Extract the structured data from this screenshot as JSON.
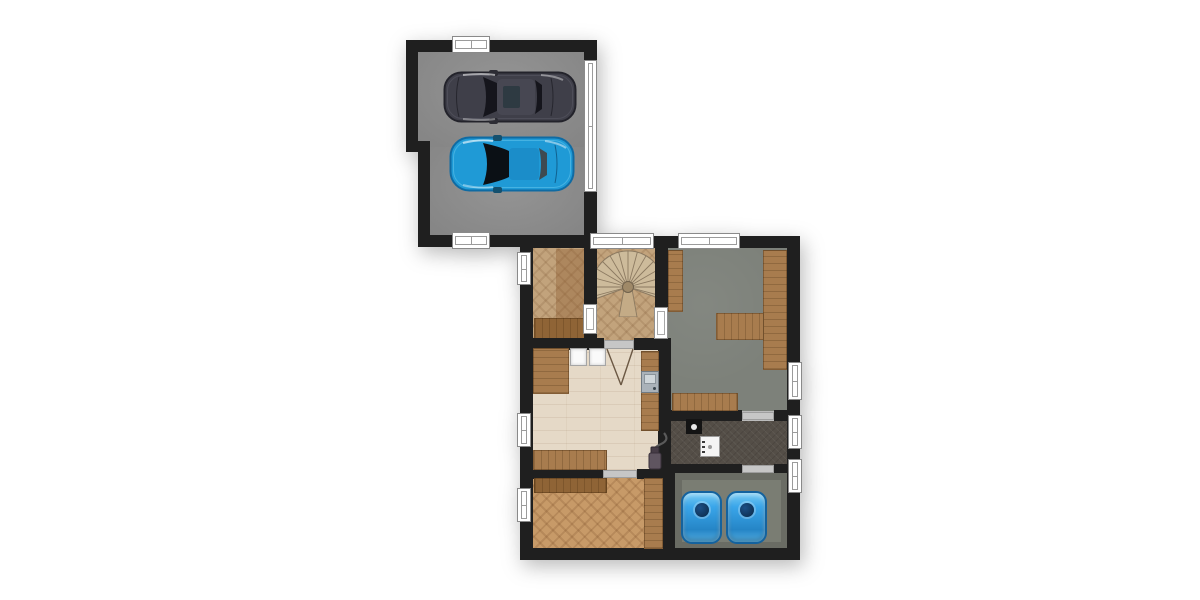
{
  "meta": {
    "description": "Top-down architectural floor plan: two-car garage attached to a lower level with stair hall, workshop, utility rooms and tank room",
    "visible_text": "none"
  },
  "colors": {
    "wall": "#1f1f1f",
    "garage_floor": "#8e8e8e",
    "workshop_floor": "#7d817a",
    "boiler_floor": "#544e47",
    "tank_floor": "#7a7d73",
    "kitchen_floor": "#e5d9c7",
    "parquet": "#c2a37c",
    "parquet_warm": "#c79a68",
    "wood": "#a87c4e",
    "wood_dark": "#8f6436",
    "window_frame": "#8a8a8a",
    "door_sill": "#c6c6c6",
    "tank_blue": "#3aa6ea",
    "car_dark": "#3f3f49",
    "car_blue": "#1f9ad6",
    "stair_tread": "#cdbb9b",
    "stair_line": "#8c7a61"
  },
  "garage": {
    "name": "garage",
    "cars": [
      {
        "name": "dark-sedan",
        "color": "#3f3f49"
      },
      {
        "name": "blue-sedan",
        "color": "#1f9ad6"
      }
    ],
    "fixtures": [
      "window-top",
      "window-bottom",
      "garage-door-right"
    ]
  },
  "rooms": [
    {
      "name": "parquet-room-northwest",
      "floor": "herringbone-parquet",
      "fixtures": [
        "window-left",
        "wardrobe",
        "bench-bottom",
        "door-to-stair-hall"
      ]
    },
    {
      "name": "stair-hall",
      "floor": "herringbone-parquet",
      "fixtures": [
        "spiral-staircase",
        "window-top",
        "door-to-workshop",
        "swing-door-to-utility-room"
      ]
    },
    {
      "name": "workshop",
      "floor": "concrete",
      "fixtures": [
        "window-top",
        "window-right",
        "wall-bench-left",
        "wall-bench-right-t-shape",
        "wall-bench-bottom",
        "door-to-boiler-room"
      ]
    },
    {
      "name": "utility-laundry-room",
      "floor": "light-plank",
      "fixtures": [
        "counter-top-left",
        "washer",
        "dryer",
        "counter-right",
        "sink-unit",
        "counter-bottom-left",
        "vacuum-cleaner",
        "window-left"
      ]
    },
    {
      "name": "parquet-room-southwest",
      "floor": "herringbone-parquet-warm",
      "fixtures": [
        "shelf-top-left",
        "plank-strip-right",
        "window-left",
        "door-top"
      ]
    },
    {
      "name": "boiler-room",
      "floor": "dark-carpet",
      "fixtures": [
        "support-column",
        "white-appliance",
        "window-right",
        "door-top",
        "door-bottom"
      ]
    },
    {
      "name": "tank-room",
      "floor": "concrete",
      "fixtures": [
        "water-tank-left",
        "water-tank-right",
        "window-right"
      ],
      "tank_count": 2
    }
  ]
}
